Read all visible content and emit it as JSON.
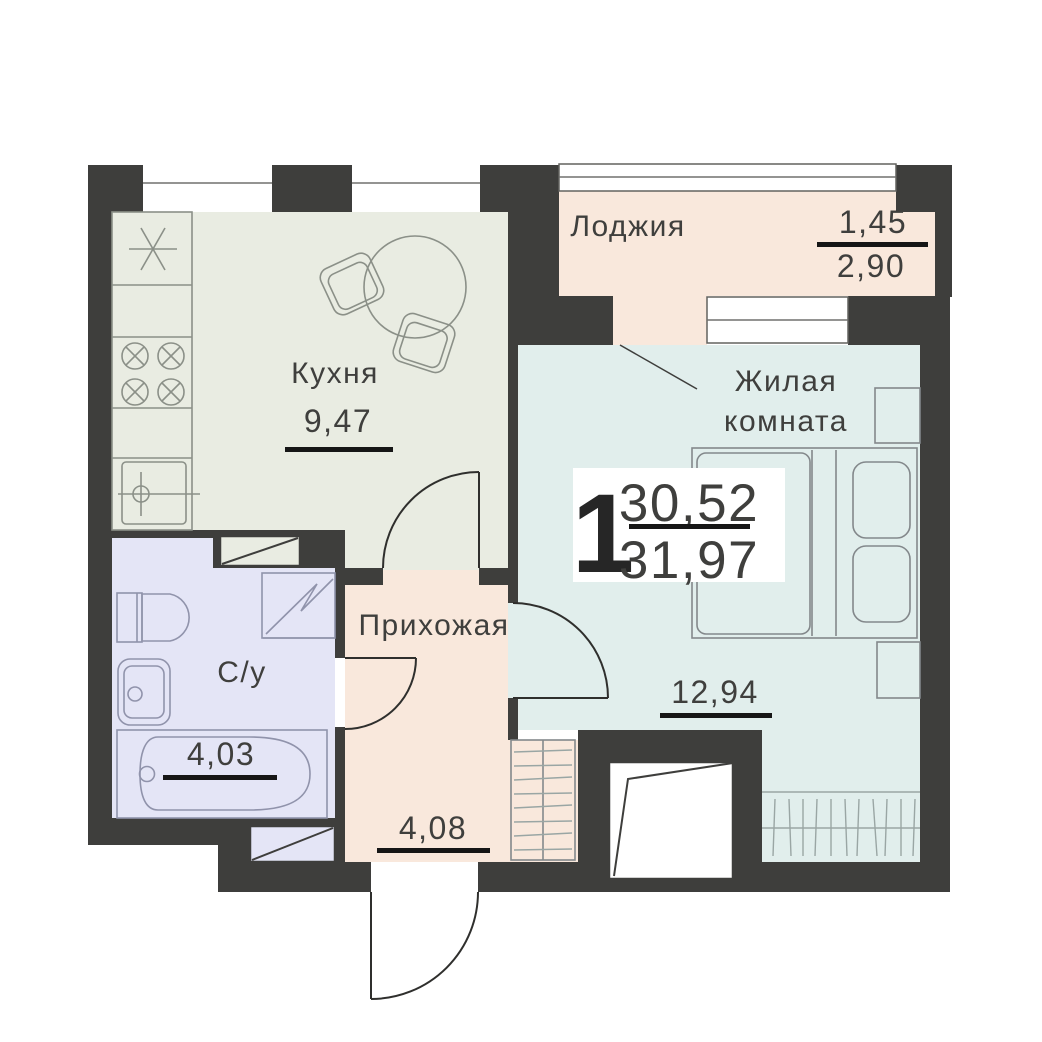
{
  "floorplan": {
    "summary": {
      "rooms_count": "1",
      "living_area": "30,52",
      "total_area": "31,97"
    },
    "rooms": {
      "loggia": {
        "label": "Лоджия",
        "coefficient_area": "1,45",
        "full_area": "2,90"
      },
      "kitchen": {
        "label": "Кухня",
        "area": "9,47"
      },
      "living": {
        "label_line1": "Жилая",
        "label_line2": "комната",
        "area": "12,94"
      },
      "hallway": {
        "label": "Прихожая",
        "area": "4,08"
      },
      "bathroom": {
        "label": "С/у",
        "area": "4,03"
      }
    },
    "colors": {
      "wall": "#3e3e3c",
      "kitchen_fill": "#e9ece2",
      "living_fill": "#e1eeec",
      "loggia_fill": "#f9e8dc",
      "bathroom_fill": "#e4e5f6",
      "underline": "#161616",
      "text": "#3f3f3d"
    }
  }
}
